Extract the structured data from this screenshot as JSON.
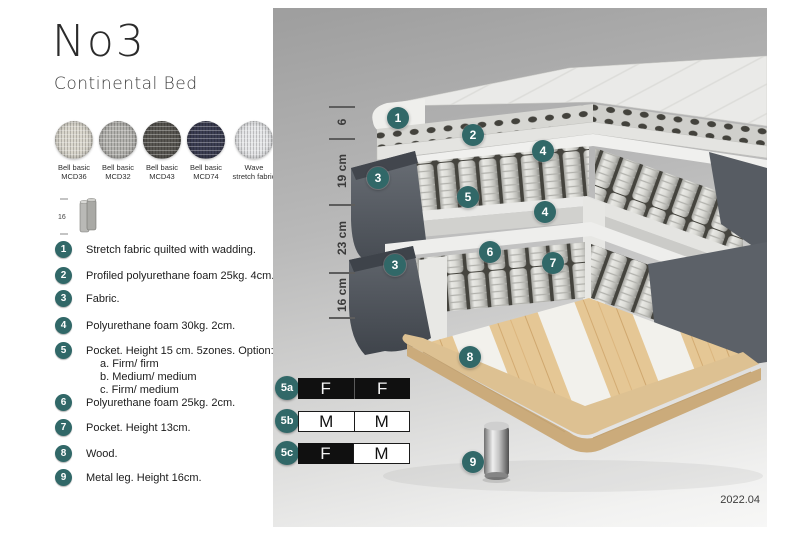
{
  "header": {
    "title": "No3",
    "subtitle": "Continental Bed"
  },
  "swatches": [
    {
      "line1": "Bell basic",
      "line2": "MCD36",
      "color": "#d9d6cc"
    },
    {
      "line1": "Bell basic",
      "line2": "MCD32",
      "color": "#b3b2ae"
    },
    {
      "line1": "Bell basic",
      "line2": "MCD43",
      "color": "#585651"
    },
    {
      "line1": "Bell basic",
      "line2": "MCD74",
      "color": "#3b3d52"
    },
    {
      "line1": "Wave",
      "line2": "stretch fabric",
      "color": "#e4e5e7"
    }
  ],
  "leg_icon": {
    "label": "16"
  },
  "legend": {
    "items": [
      {
        "num": "1",
        "text": "Stretch fabric quilted with wadding."
      },
      {
        "num": "2",
        "text": "Profiled polyurethane foam 25kg. 4cm."
      },
      {
        "num": "3",
        "text": "Fabric."
      },
      {
        "num": "4",
        "text": "Polyurethane foam 30kg. 2cm."
      },
      {
        "num": "5",
        "text": "Pocket. Height 15 cm. 5zones. Option:",
        "sub": [
          "a. Firm/ firm",
          "b. Medium/ medium",
          "c. Firm/ medium"
        ]
      },
      {
        "num": "6",
        "text": "Polyurethane foam 25kg. 2cm."
      },
      {
        "num": "7",
        "text": "Pocket. Height 13cm."
      },
      {
        "num": "8",
        "text": "Wood."
      },
      {
        "num": "9",
        "text": "Metal leg. Height 16cm."
      }
    ]
  },
  "illustration": {
    "ruler": [
      {
        "label": "6"
      },
      {
        "label": "19 cm"
      },
      {
        "label": "23 cm"
      },
      {
        "label": "16 cm"
      }
    ],
    "badges": [
      {
        "n": "1"
      },
      {
        "n": "2"
      },
      {
        "n": "4"
      },
      {
        "n": "3"
      },
      {
        "n": "5"
      },
      {
        "n": "4"
      },
      {
        "n": "6"
      },
      {
        "n": "7"
      },
      {
        "n": "3"
      },
      {
        "n": "8"
      },
      {
        "n": "9"
      }
    ]
  },
  "firmness_table": {
    "rows": [
      {
        "label": "5a",
        "cells": [
          {
            "letter": "F"
          },
          {
            "letter": "F"
          }
        ]
      },
      {
        "label": "5b",
        "cells": [
          {
            "letter": "M"
          },
          {
            "letter": "M"
          }
        ]
      },
      {
        "label": "5c",
        "cells": [
          {
            "letter": "F"
          },
          {
            "letter": "M"
          }
        ]
      }
    ]
  },
  "footer": {
    "version": "2022.04"
  },
  "colors": {
    "badge_teal": "#316868",
    "table_black": "#101010",
    "panel_grey_top": "#9f9f9f",
    "panel_grey_bottom": "#f7f7f6"
  }
}
